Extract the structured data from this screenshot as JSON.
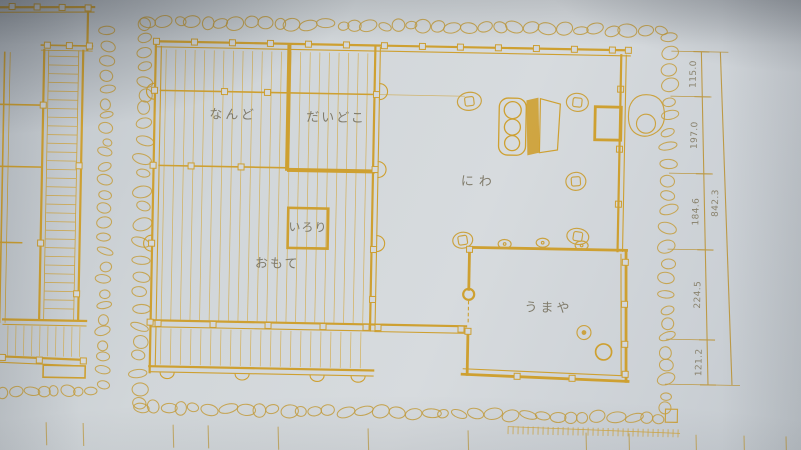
{
  "photo": {
    "subject": "japanese-farmhouse-floor-plan",
    "paper_color": "#d2d7da",
    "ink_color": "#d0a02b",
    "label_color": "#7a7461"
  },
  "rooms": {
    "nando": "なんど",
    "daidoko": "だいどこ",
    "irori": "いろり",
    "omote": "おもて",
    "niwa": "にわ",
    "umaya": "うまや"
  },
  "dimensions": {
    "segments": [
      "115.0",
      "197.0",
      "184.6",
      "224.5",
      "121.2"
    ],
    "overall": "842.3"
  }
}
